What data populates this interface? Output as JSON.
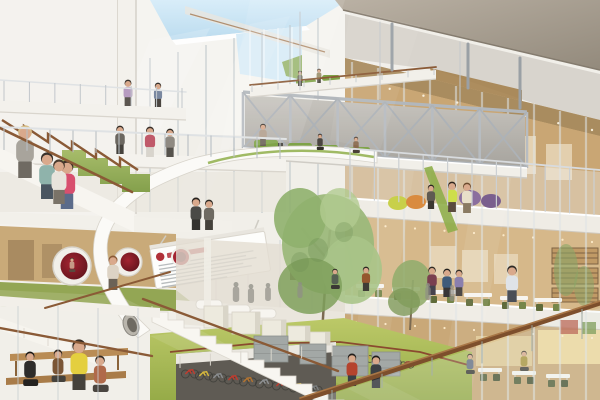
{
  "meta": {
    "title": "Architectural rendering of a multi-storey atrium interior with bridge, spiral slide, trees and bicycle parking"
  },
  "palette": {
    "sky": "#cfe6f4",
    "soffit": "#aca092",
    "steel": "#aeb4b9",
    "wood_wall": "#c9a674",
    "wood_wall_light": "#d6b88a",
    "wood_ceiling": "#a98c5f",
    "slab": "#efece5",
    "rail_wood": "#8a5a36",
    "rail_dark": "#7d4f2c",
    "green_carpet": "#93a654",
    "lawn": "#b3c05a",
    "sofa_green": "#7fa348",
    "chair_olive": "#5f6b3a",
    "pod_red": "#8a2631",
    "accent_red": "#b03038",
    "warm_glow": "#f3dd9f",
    "tree": "#9cb87b",
    "skin": "#d9a98c"
  },
  "scene": {
    "truss": {
      "x1": 243,
      "x2": 527,
      "yt1": 92,
      "yt2": 112,
      "yb1": 148,
      "yb2": 168,
      "bays": 6
    },
    "dots": [
      [
        255,
        124,
        515,
        142,
        9,
        "#e9e7e1",
        1.1
      ],
      [
        356,
        82,
        592,
        130,
        8,
        "#fdf6e6",
        1.2
      ],
      [
        356,
        224,
        592,
        242,
        9,
        "#ffeecd",
        1.1
      ],
      [
        356,
        322,
        592,
        338,
        9,
        "#ffeecd",
        1.1
      ],
      [
        10,
        234,
        158,
        241,
        6,
        "#f5f2ea",
        1.0
      ]
    ],
    "posts": [
      [
        13,
        4,
        280,
        128,
        138,
        150,
        159,
        1.1,
        "#b9bfc4"
      ],
      [
        8,
        4,
        182,
        81,
        88,
        101,
        108,
        1.0,
        "#c2c7cb"
      ],
      [
        11,
        350,
        594,
        149,
        170,
        199,
        215,
        1.2,
        "#ccd0d3"
      ],
      [
        8,
        252,
        434,
        85,
        68,
        92,
        75,
        1.0,
        "#c8ccd0"
      ],
      [
        6,
        332,
        582,
        390,
        309,
        400,
        339,
        2.0,
        "rgba(150,160,152,0.55)"
      ],
      [
        6,
        180,
        332,
        356,
        344,
        368,
        356,
        1.0,
        "#d8d5cc"
      ]
    ],
    "rails": [
      [
        0,
        127,
        286,
        139,
        2.0,
        "#dfe2e4"
      ],
      [
        0,
        80,
        186,
        92,
        1.6,
        "#dfe2e4"
      ],
      [
        345,
        148,
        600,
        170,
        1.8,
        "#d8dbde"
      ],
      [
        250,
        85,
        436,
        67,
        1.8,
        "#8a5a36"
      ],
      [
        0,
        128,
        132,
        192,
        2.6,
        "#8a5a36"
      ],
      [
        143,
        299,
        338,
        371,
        2.4,
        "#8a5a36"
      ],
      [
        0,
        328,
        152,
        356,
        2.4,
        "#8a5a36"
      ],
      [
        45,
        308,
        170,
        272,
        2.0,
        "#8a5a36"
      ],
      [
        302,
        400,
        600,
        303,
        5.0,
        "#7d4f2c"
      ],
      [
        300,
        398,
        600,
        301,
        1.6,
        "#a87646"
      ],
      [
        392,
        24,
        392,
        70,
        3.0,
        "#9aa0a5"
      ],
      [
        468,
        44,
        468,
        88,
        3.0,
        "#9aa0a5"
      ],
      [
        520,
        58,
        520,
        108,
        3.0,
        "#9aa0a5"
      ],
      [
        300,
        12,
        300,
        90,
        1.0,
        "#c3c7ca"
      ],
      [
        380,
        22,
        380,
        99,
        1.0,
        "#c3c7ca"
      ],
      [
        460,
        42,
        460,
        106,
        1.0,
        "#c3c7ca"
      ]
    ],
    "mullions": [
      [
        150,
        58,
        212,
        1.6,
        "rgba(185,193,199,0.6)",
        0
      ],
      [
        178,
        52,
        212,
        1.6,
        "rgba(185,193,199,0.6)",
        0
      ],
      [
        206,
        45,
        212,
        1.6,
        "rgba(185,193,199,0.6)",
        0
      ],
      [
        234,
        38,
        212,
        1.6,
        "rgba(185,193,199,0.6)",
        0
      ],
      [
        262,
        32,
        213,
        1.6,
        "rgba(185,193,199,0.6)",
        0
      ],
      [
        290,
        25,
        213,
        1.6,
        "rgba(185,193,199,0.6)",
        0
      ],
      [
        318,
        18,
        214,
        1.6,
        "rgba(185,193,199,0.6)",
        0
      ],
      [
        352,
        62,
        400,
        2.2,
        "rgba(222,227,230,0.55)",
        0
      ],
      [
        378,
        68,
        400,
        2.2,
        "rgba(222,227,230,0.55)",
        0
      ],
      [
        404,
        74,
        400,
        2.2,
        "rgba(222,227,230,0.55)",
        0
      ],
      [
        430,
        80,
        400,
        2.2,
        "rgba(222,227,230,0.55)",
        0
      ],
      [
        456,
        86,
        400,
        2.2,
        "rgba(222,227,230,0.55)",
        0
      ],
      [
        482,
        92,
        400,
        2.2,
        "rgba(222,227,230,0.55)",
        0
      ],
      [
        508,
        98,
        400,
        2.2,
        "rgba(222,227,230,0.55)",
        0
      ],
      [
        534,
        104,
        400,
        2.2,
        "rgba(222,227,230,0.55)",
        0
      ],
      [
        560,
        111,
        400,
        2.2,
        "rgba(222,227,230,0.55)",
        0
      ],
      [
        586,
        117,
        400,
        2.2,
        "rgba(222,227,230,0.55)",
        0
      ],
      [
        216,
        236,
        334,
        1.4,
        "rgba(190,198,204,0.45)",
        0
      ],
      [
        248,
        238,
        334,
        1.4,
        "rgba(190,198,204,0.45)",
        0
      ],
      [
        280,
        240,
        336,
        1.4,
        "rgba(190,198,204,0.45)",
        0
      ],
      [
        312,
        242,
        336,
        1.4,
        "rgba(190,198,204,0.45)",
        0
      ],
      [
        250,
        30,
        80,
        1.0,
        "rgba(255,255,255,0.75)",
        0
      ],
      [
        264,
        29,
        81,
        1.0,
        "rgba(255,255,255,0.75)",
        0
      ],
      [
        278,
        28,
        82,
        1.0,
        "rgba(255,255,255,0.75)",
        0
      ],
      [
        292,
        27,
        83,
        1.0,
        "rgba(255,255,255,0.75)",
        0
      ],
      [
        18,
        306,
        400,
        1.6,
        "rgba(200,206,210,0.5)",
        1
      ],
      [
        58,
        306,
        400,
        1.6,
        "rgba(200,206,210,0.5)",
        1
      ],
      [
        98,
        308,
        400,
        1.6,
        "rgba(200,206,210,0.5)",
        1
      ],
      [
        138,
        308,
        400,
        1.6,
        "rgba(200,206,210,0.5)",
        1
      ]
    ],
    "board": {
      "x": 152,
      "y": 240,
      "w": 116,
      "h": 40,
      "rows": [
        96,
        88,
        98,
        84,
        92,
        78,
        66
      ],
      "row_h": 1.3
    },
    "sofas": [
      [
        254,
        140,
        24,
        8
      ],
      [
        288,
        143,
        24,
        8
      ],
      [
        314,
        145,
        24,
        8
      ],
      [
        348,
        147,
        22,
        8
      ],
      [
        296,
        79,
        20,
        6
      ],
      [
        322,
        75,
        18,
        6
      ]
    ],
    "beanbags": [
      [
        470,
        198,
        11,
        8,
        "#8b6f9e"
      ],
      [
        491,
        201,
        10,
        7,
        "#7a5f8e"
      ],
      [
        398,
        203,
        10,
        7,
        "#c8d04a"
      ],
      [
        416,
        202,
        10,
        7,
        "#d98b3f"
      ]
    ],
    "tables_l3": [
      [
        356,
        284
      ],
      [
        392,
        287
      ],
      [
        428,
        290
      ],
      [
        464,
        293
      ],
      [
        500,
        296
      ],
      [
        534,
        298
      ]
    ],
    "tables_ground": [
      [
        408,
        360
      ],
      [
        444,
        364
      ],
      [
        478,
        368
      ],
      [
        512,
        371
      ],
      [
        546,
        374
      ]
    ],
    "hall_sofas": [
      [
        196,
        300
      ],
      [
        224,
        305
      ],
      [
        250,
        309
      ]
    ],
    "cubes": [
      [
        204,
        306,
        24,
        22
      ],
      [
        232,
        312,
        28,
        22
      ],
      [
        262,
        320,
        24,
        17
      ],
      [
        288,
        326,
        22,
        15
      ],
      [
        310,
        332,
        20,
        13
      ]
    ],
    "lockers": [
      [
        254,
        336,
        34,
        26
      ],
      [
        300,
        344,
        26,
        20
      ],
      [
        332,
        346,
        36,
        30
      ],
      [
        372,
        352,
        28,
        24
      ]
    ],
    "bikes": [
      [
        190,
        374,
        1.0,
        "#c23b2e"
      ],
      [
        204,
        376,
        1.0,
        "#d8b93c"
      ],
      [
        218,
        378,
        1.0,
        "#8a8d90"
      ],
      [
        233,
        380,
        1.0,
        "#c23b2e"
      ],
      [
        248,
        382,
        1.0,
        "#b5742f"
      ],
      [
        264,
        384,
        1.0,
        "#8f9294"
      ],
      [
        281,
        386,
        1.0,
        "#c23b2e"
      ],
      [
        298,
        388,
        1.0,
        "#d8b93c"
      ],
      [
        314,
        390,
        0.95,
        "#7d8082"
      ],
      [
        352,
        356,
        0.85,
        "#b0443a"
      ],
      [
        366,
        359,
        0.85,
        "#c9a23c"
      ],
      [
        380,
        361,
        0.85,
        "#8a8d90"
      ],
      [
        394,
        363,
        0.85,
        "#b5742f"
      ],
      [
        407,
        365,
        0.8,
        "#9a4b40"
      ]
    ],
    "people": [
      [
        25,
        178,
        52,
        "#a8a49c",
        "#6f6a62",
        "#d8c08a",
        "st"
      ],
      [
        47,
        199,
        46,
        "#8fb3ab",
        "#4a5560",
        "#3a332c",
        "st"
      ],
      [
        67,
        209,
        48,
        "#d84f6e",
        "#5b6b8a",
        "#3a2f28",
        "st"
      ],
      [
        59,
        204,
        44,
        "#e8e4dc",
        "#7a7368",
        "#4a3b2e",
        "st"
      ],
      [
        128,
        106,
        26,
        "#b79bc0",
        "#5c5650",
        "#3a332c",
        "st"
      ],
      [
        158,
        107,
        24,
        "#7a88a0",
        "#4a4540",
        "#2e2a24",
        "st"
      ],
      [
        120,
        154,
        28,
        "#6b6760",
        "#45423c",
        "#332c26",
        "st"
      ],
      [
        150,
        157,
        30,
        "#c05a6a",
        "#d8d4cc",
        "#3a2f28",
        "st"
      ],
      [
        170,
        157,
        28,
        "#8f8a82",
        "#55524c",
        "#2e2a24",
        "st"
      ],
      [
        196,
        230,
        32,
        "#4a4a46",
        "#33322e",
        "#26221e",
        "st"
      ],
      [
        209,
        230,
        30,
        "#6e6a62",
        "#44413b",
        "#2e2a24",
        "st"
      ],
      [
        300,
        86,
        15,
        "#777468",
        "#4a473f",
        "#2e2a24",
        "st"
      ],
      [
        319,
        83,
        14,
        "#9a8f6a",
        "#55524a",
        "#332e26",
        "st"
      ],
      [
        263,
        146,
        22,
        "#b3a08e",
        "#6b6257",
        "#3a332c",
        "st"
      ],
      [
        320,
        150,
        16,
        "#4a4540",
        "#33302a",
        "#26221e",
        "si"
      ],
      [
        356,
        153,
        16,
        "#8a6b4f",
        "#4a4038",
        "#2e261e",
        "si"
      ],
      [
        452,
        212,
        30,
        "#cede4a",
        "#5a4a3e",
        "#2e241c",
        "st"
      ],
      [
        467,
        213,
        30,
        "#e8dfc9",
        "#8a7a62",
        "#6b4a2e",
        "st"
      ],
      [
        431,
        209,
        24,
        "#5f5a52",
        "#3b3832",
        "#26221e",
        "st"
      ],
      [
        512,
        302,
        36,
        "#dfe3e8",
        "#4a4f57",
        "#2e2a26",
        "st"
      ],
      [
        432,
        295,
        28,
        "#7a3f4f",
        "#45424c",
        "#2e2a24",
        "st"
      ],
      [
        447,
        297,
        28,
        "#3f5b7a",
        "#383636",
        "#221f1c",
        "st"
      ],
      [
        459,
        296,
        26,
        "#8a7fae",
        "#4c4846",
        "#332e28",
        "st"
      ],
      [
        366,
        291,
        24,
        "#95572e",
        "#3f3c36",
        "#26221e",
        "st"
      ],
      [
        335,
        289,
        20,
        "#556052",
        "#3a3834",
        "#221f1c",
        "si"
      ],
      [
        470,
        374,
        20,
        "#667084",
        "#3c3a36",
        "#26221e",
        "si"
      ],
      [
        524,
        371,
        20,
        "#a9953e",
        "#45423c",
        "#2e2a24",
        "si"
      ],
      [
        352,
        386,
        32,
        "#b5432e",
        "#3a3f46",
        "#221f1c",
        "st"
      ],
      [
        376,
        388,
        32,
        "#3c4044",
        "#2c2e32",
        "#1e1c1a",
        "st"
      ],
      [
        72,
        272,
        14,
        "#c59a86",
        "#5a4a3e",
        "#3a2f26",
        "si"
      ],
      [
        113,
        290,
        34,
        "#ddd3c4",
        "#6b6257",
        "#8a5a36",
        "st"
      ],
      [
        236,
        302,
        20,
        "#8e8d86",
        "#8e8d86",
        "#8e8d86",
        "sl"
      ],
      [
        251,
        303,
        19,
        "#8e8d86",
        "#8e8d86",
        "#8e8d86",
        "sl"
      ],
      [
        268,
        301,
        18,
        "#8e8d86",
        "#8e8d86",
        "#8e8d86",
        "sl"
      ],
      [
        300,
        298,
        16,
        "#8e8d86",
        "#8e8d86",
        "#8e8d86",
        "sl"
      ],
      [
        428,
        300,
        17,
        "#8e8d86",
        "#8e8d86",
        "#8e8d86",
        "sl"
      ],
      [
        452,
        301,
        16,
        "#8e8d86",
        "#8e8d86",
        "#8e8d86",
        "sl"
      ],
      [
        79,
        390,
        50,
        "#e4cf3f",
        "#45423c",
        "#3a2f26",
        "st"
      ],
      [
        30,
        386,
        34,
        "#2e2c2a",
        "#242220",
        "#1a1816",
        "si"
      ],
      [
        58,
        382,
        32,
        "#7a5535",
        "#45423c",
        "#2e241c",
        "si"
      ],
      [
        100,
        392,
        36,
        "#b06a4a",
        "#4a4540",
        "#332a22",
        "si"
      ]
    ]
  }
}
